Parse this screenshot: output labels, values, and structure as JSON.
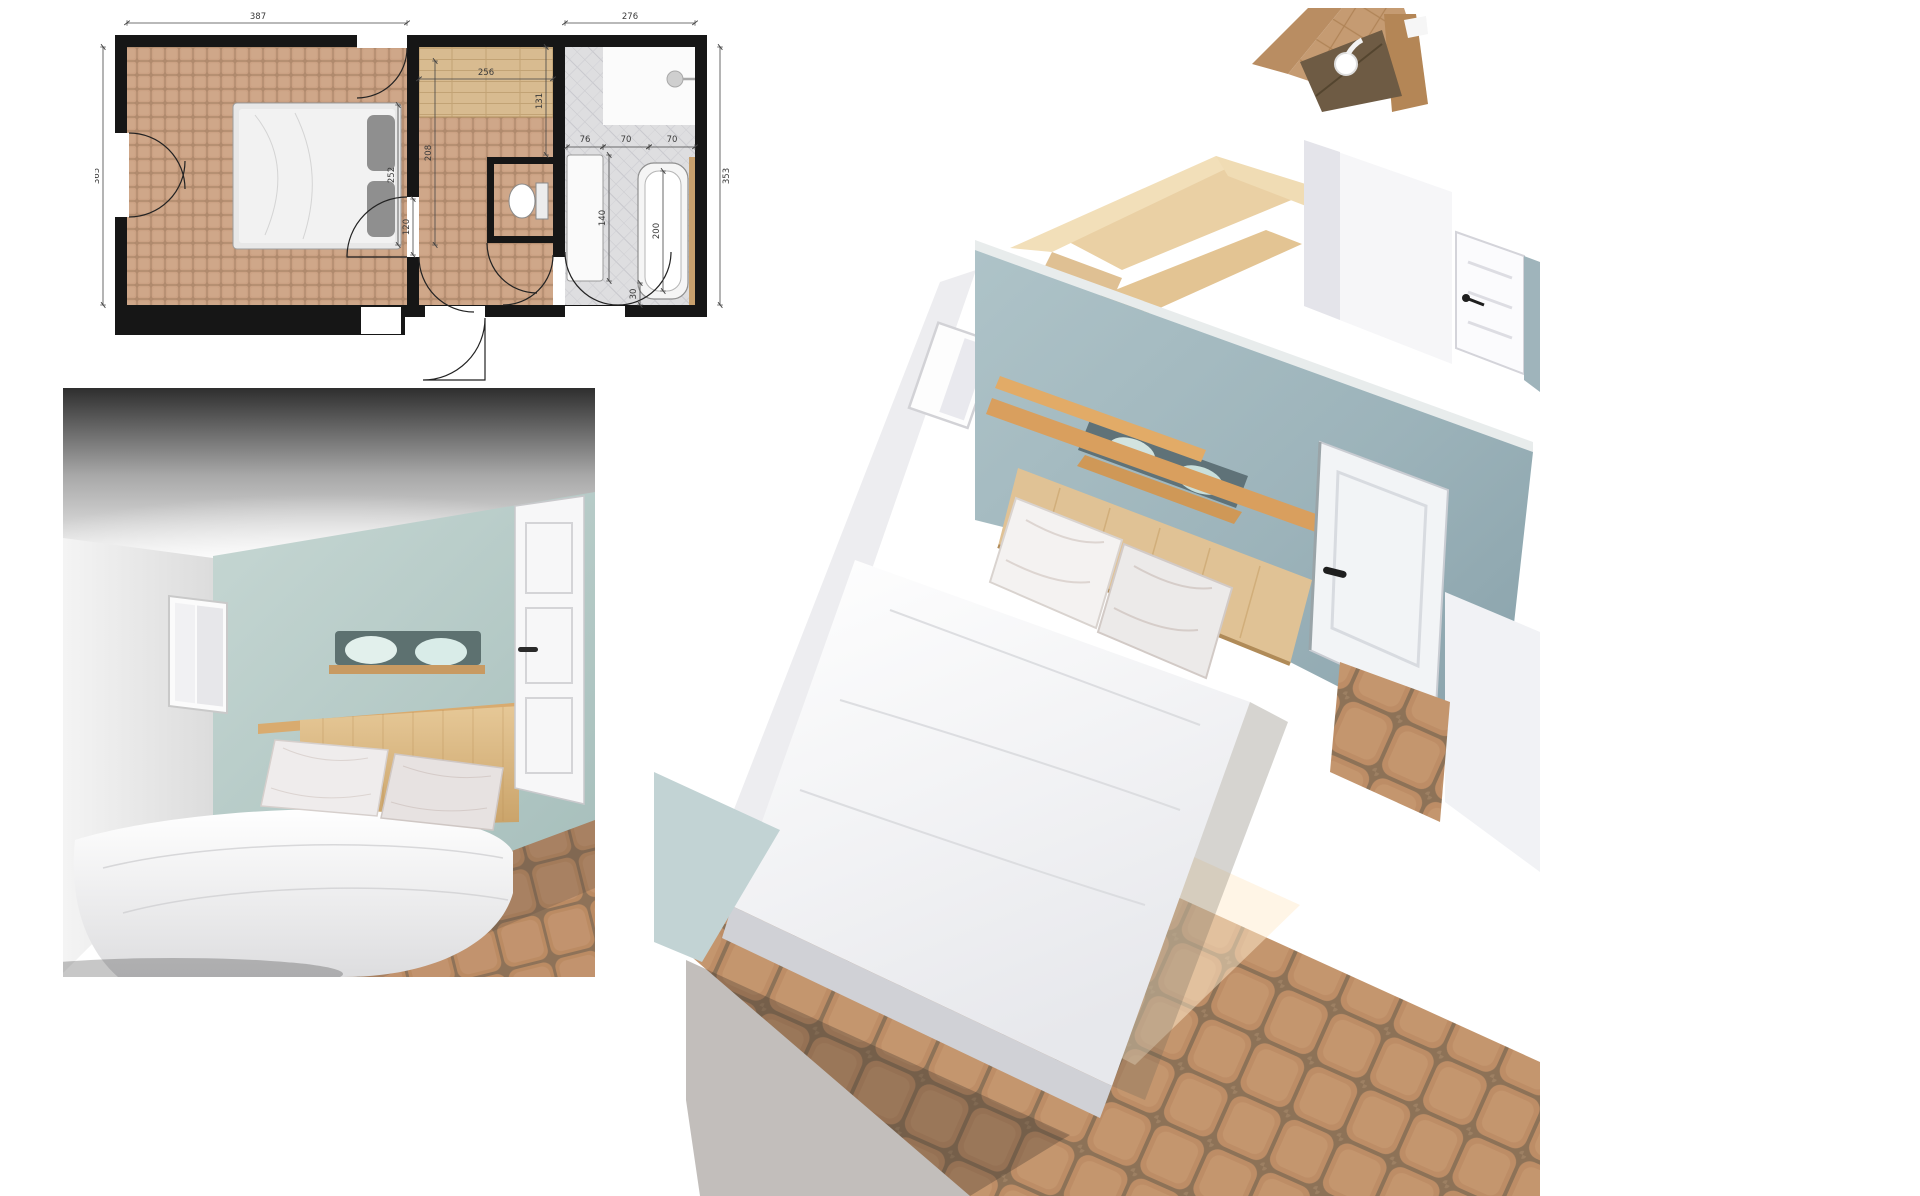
{
  "document": {
    "kind": "interior-design-presentation",
    "room": "bedroom-with-dressing-and-bathroom",
    "background": "#ffffff"
  },
  "floor_plan": {
    "dim_bedroom_width": "387",
    "dim_bathroom_width": "276",
    "dim_left_height": "365",
    "dim_right_height": "353",
    "dim_dressing_width": "256",
    "dim_dressing_depth": "131",
    "dim_closet_run": "208",
    "dim_bed_length": "252",
    "dim_door_clear": "120",
    "dim_vanity_width": "76",
    "dim_shower_width": "70",
    "dim_tub_width": "70",
    "dim_vanity_run": "140",
    "dim_tub_length": "200",
    "dim_tub_margin": "30"
  },
  "icons": [
    "shower-head-icon",
    "toilet-icon",
    "bathtub-icon",
    "door-swing-arc"
  ],
  "colors": {
    "plan_wall": "#161616",
    "plan_tile_terracotta": "#cba183",
    "plan_wood": "#d8bb90",
    "plan_tile_gray": "#dedee0",
    "render_wall_blue_light": "#b9cdc9",
    "render_wall_blue_aerial": "#a3bac1",
    "render_wood_headboard": "#dfc194",
    "render_wood_ledge": "#d39a5d",
    "render_floor_tile": "#c0936b",
    "render_white_wall": "#f4f4f6"
  }
}
